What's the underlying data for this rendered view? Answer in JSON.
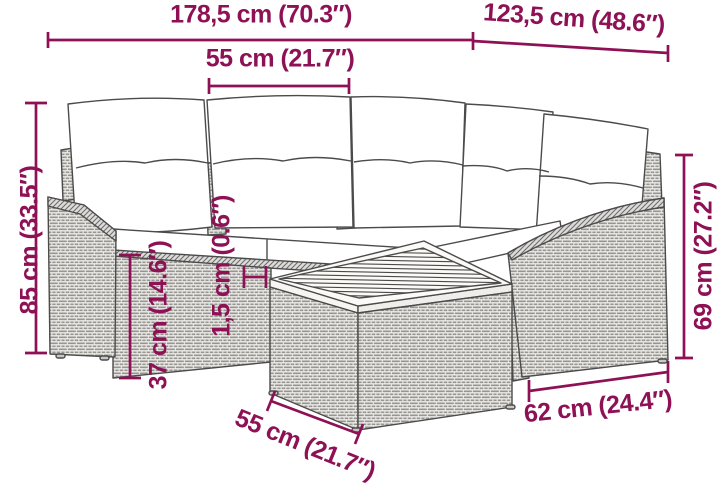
{
  "colors": {
    "accent": "#8E1156",
    "line_art": "#4b4b4b",
    "rattan_fill": "#ecebe9",
    "cushion_fill": "#ffffff"
  },
  "figure": {
    "description_labels": {
      "total_width": "178,5 cm (70.3″)",
      "right_section_width": "123,5 cm (48.6″)",
      "cushion_width": "55 cm (21.7″)",
      "total_height": "85 cm (33.5″)",
      "seat_height": "37 cm (14.6″)",
      "tabletop_thickness": "1,5 cm (0.6″)",
      "right_section_height": "69 cm (27.2″)",
      "right_section_depth": "62 cm (24.4″)",
      "table_width": "55 cm (21.7″)"
    }
  }
}
